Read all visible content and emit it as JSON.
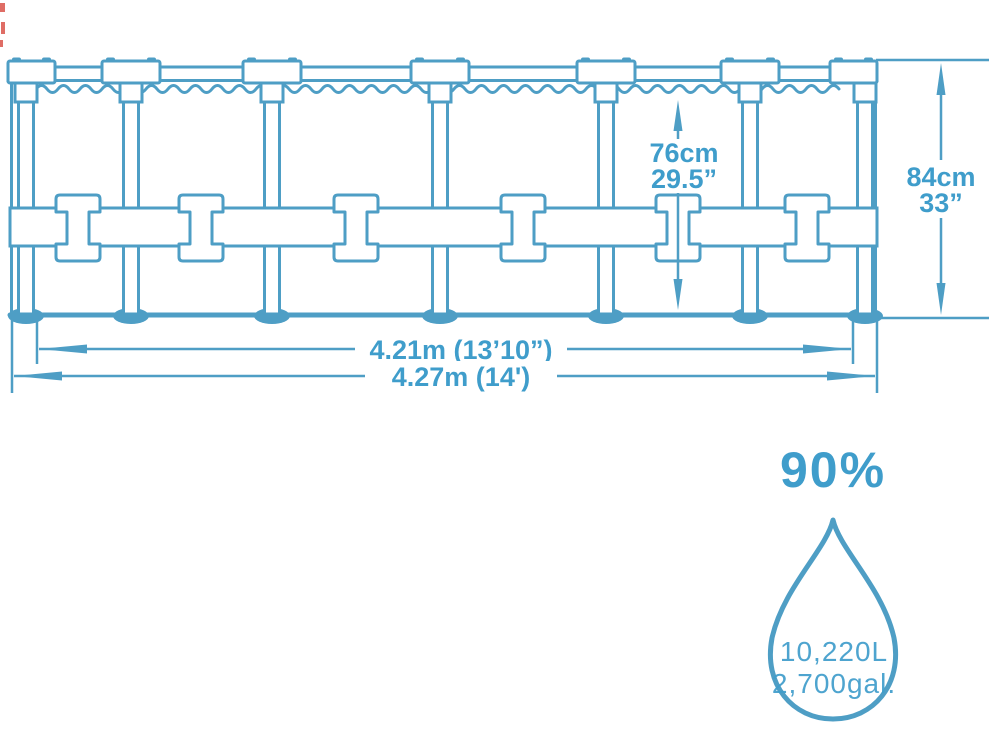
{
  "diagram": {
    "type": "pool-frame-dimension-diagram",
    "water_depth_metric": "76cm",
    "water_depth_imperial": "29.5”",
    "height_metric": "84cm",
    "height_imperial": "33”",
    "inner_diameter_label": "4.21m (13’10”)",
    "outer_diameter_label": "4.27m (14')",
    "capacity": {
      "fill_percent": "90%",
      "liters": "10,220L",
      "gallons": "2,700gal."
    }
  },
  "colors": {
    "line": "#4E9EC5",
    "text": "#3F9DCB",
    "background": "#FFFFFF",
    "artifact": "#D9534A"
  }
}
